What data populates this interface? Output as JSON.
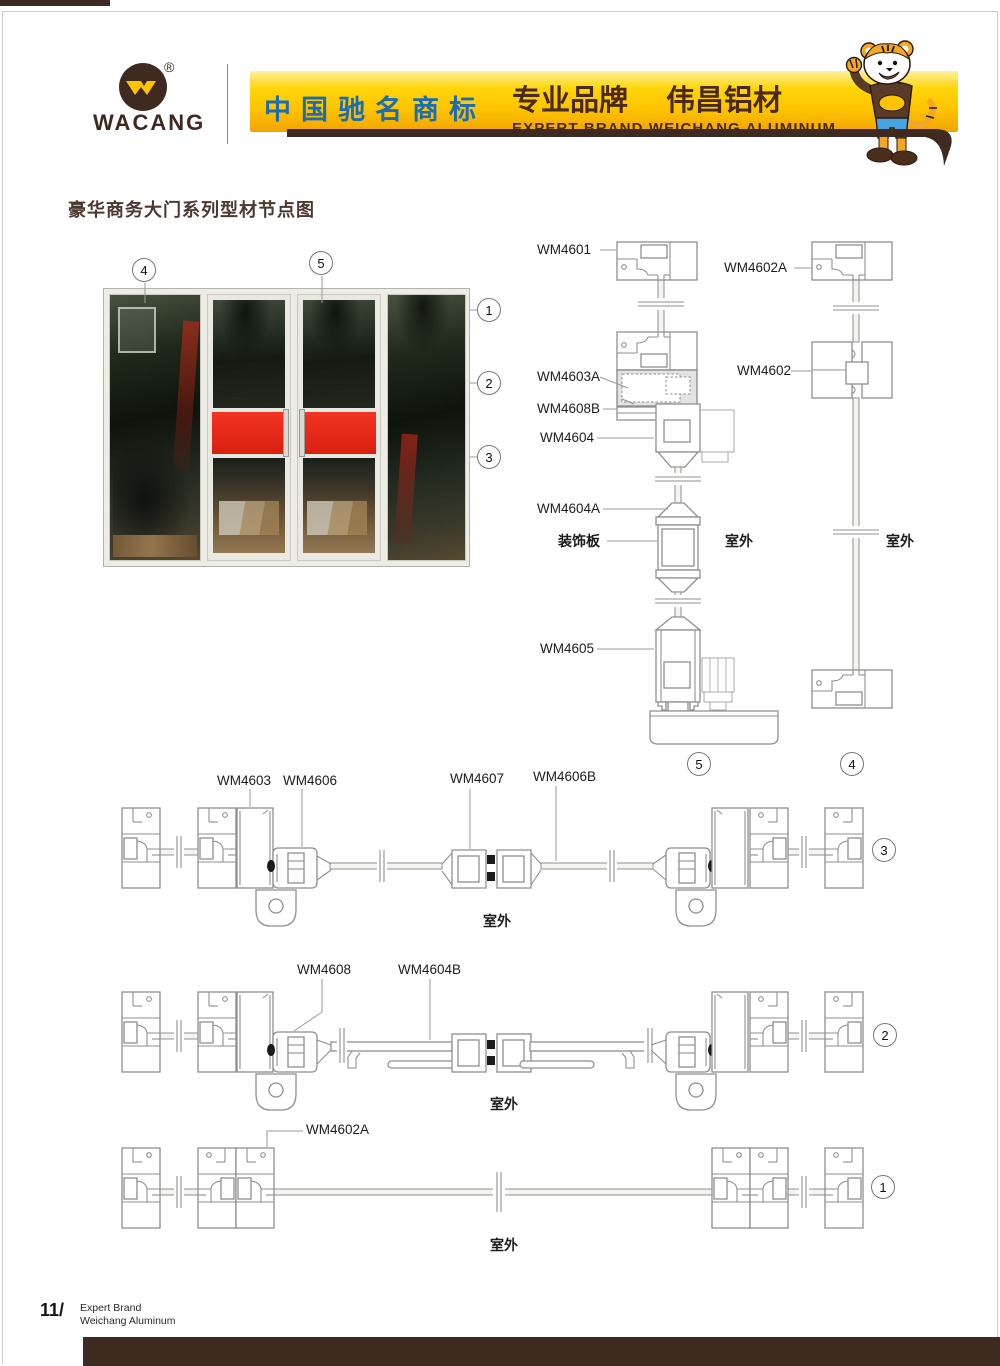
{
  "header": {
    "logo_text": "WACANG",
    "registered_mark": "®",
    "banner": {
      "cn_left": "中国驰名商标",
      "cn_right_1": "专业品牌",
      "cn_right_2": "伟昌铝材",
      "en": "EXPERT BRAND WEICHANG ALUMINUM"
    }
  },
  "title": "豪华商务大门系列型材节点图",
  "diagram": {
    "labels": {
      "wm4601": "WM4601",
      "wm4602a": "WM4602A",
      "wm4603a": "WM4603A",
      "wm4608b": "WM4608B",
      "wm4604": "WM4604",
      "wm4602": "WM4602",
      "wm4604a": "WM4604A",
      "wm4605": "WM4605",
      "wm4603": "WM4603",
      "wm4606": "WM4606",
      "wm4607": "WM4607",
      "wm4606b": "WM4606B",
      "wm4608": "WM4608",
      "wm4604b": "WM4604B",
      "wm4602a_plan": "WM4602A"
    },
    "annotations": {
      "outdoor": "室外",
      "decorative_panel": "装饰板"
    },
    "markers": {
      "m1": "1",
      "m2": "2",
      "m3": "3",
      "m4": "4",
      "m5": "5"
    }
  },
  "footer": {
    "page_number": "11/",
    "tagline_line1": "Expert Brand",
    "tagline_line2": "Weichang Aluminum"
  }
}
